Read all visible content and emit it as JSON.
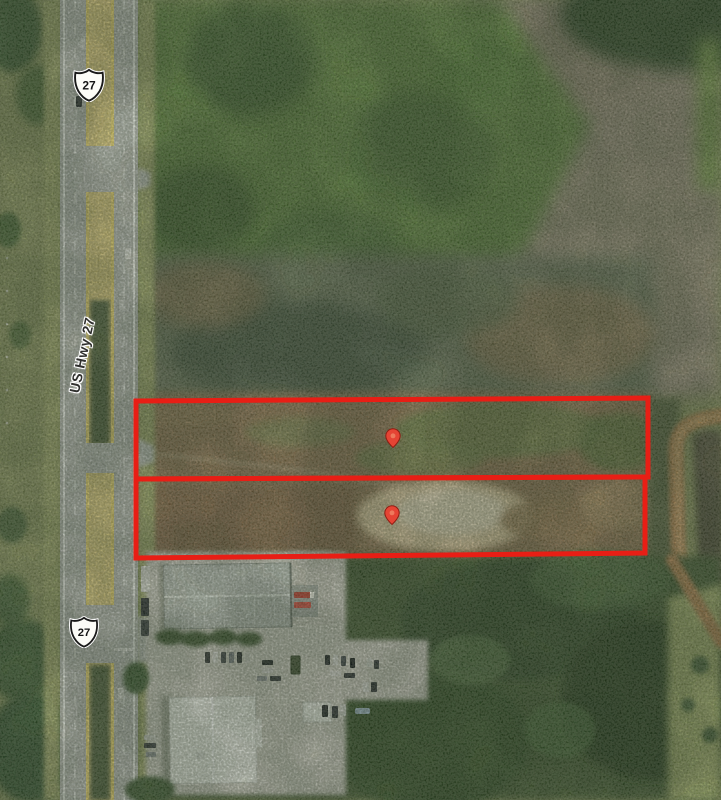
{
  "map": {
    "type": "aerial-satellite",
    "road_label": "US Hwy 27"
  },
  "shields": [
    {
      "id": "north",
      "number": "27"
    },
    {
      "id": "south",
      "number": "27"
    }
  ],
  "overlay": {
    "outline_color": "#e81e15",
    "pin_color": "#e54434",
    "parcels": [
      {
        "id": "north-parcel",
        "points": "136,401 648,398 648,477 136,479"
      },
      {
        "id": "south-parcel",
        "points": "136,479 645,477 645,553 136,558"
      }
    ],
    "pins": [
      {
        "id": "pin-north",
        "transform": "translate(385.8,428.8) scale(0.72)"
      },
      {
        "id": "pin-south",
        "transform": "translate(384.8,505.8) scale(0.72)"
      }
    ]
  }
}
